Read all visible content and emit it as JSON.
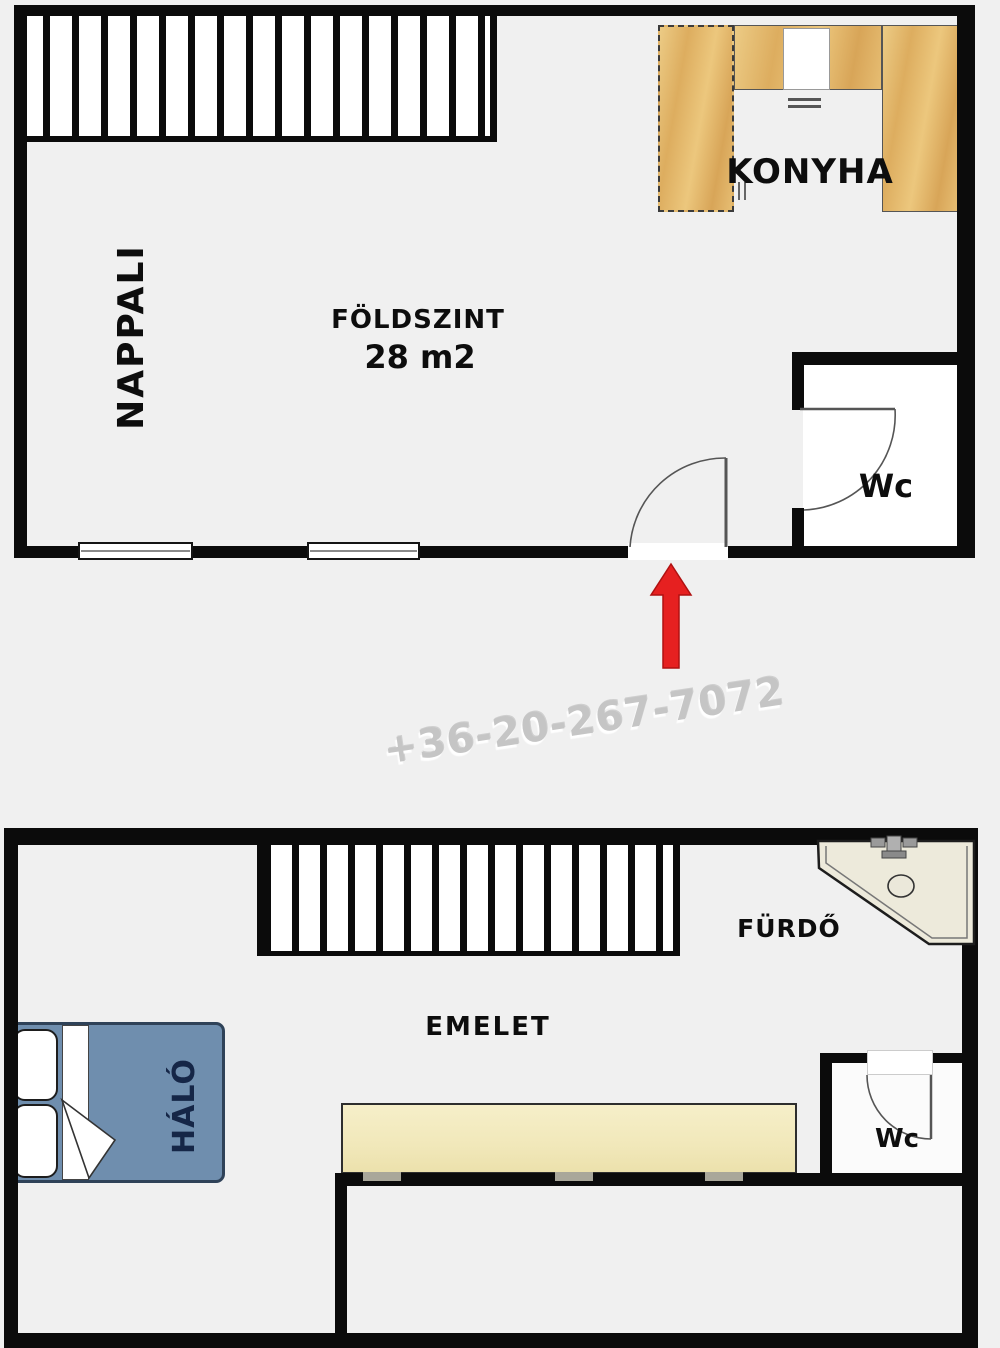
{
  "title": "Two-level apartment floor plan",
  "watermark": {
    "phone": "+36-20-267-7072"
  },
  "ground_floor": {
    "name": "FÖLDSZINT",
    "area": "28 m2",
    "rooms": {
      "living": "NAPPALI",
      "kitchen": "KONYHA",
      "wc": "Wc"
    }
  },
  "upper_floor": {
    "name": "EMELET",
    "rooms": {
      "bedroom": "HÁLÓ",
      "bathroom": "FÜRDŐ",
      "wc": "Wc"
    }
  },
  "colors": {
    "background": "#f0f0f0",
    "wall": "#0b0b0b",
    "kitchen_wood": "#e3b873",
    "counter_wood": "#f3ecc2",
    "bed_blue": "#6f8eae",
    "tub_cream": "#edeadb",
    "entrance_arrow_red": "#e62020",
    "watermark_gray": "#c5c5c5"
  }
}
